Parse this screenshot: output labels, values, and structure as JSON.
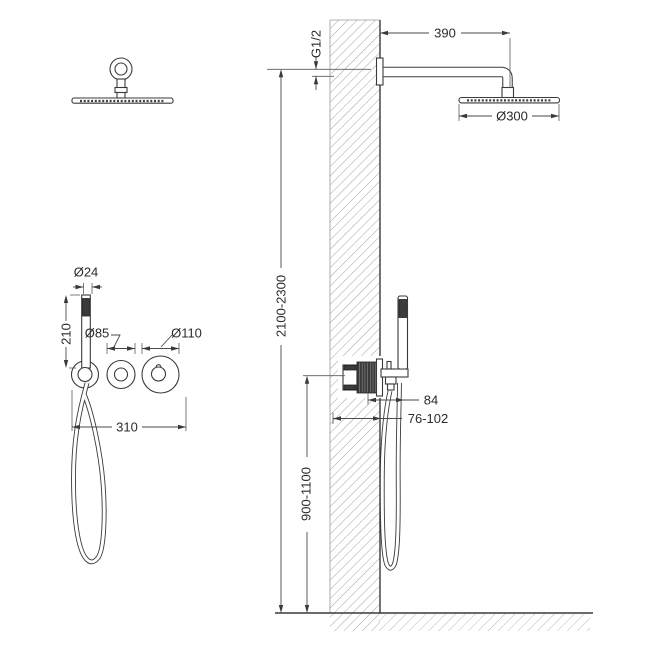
{
  "drawing": {
    "colors": {
      "line": "#3a3a3a",
      "hatch": "#9a9a9a",
      "background": "#ffffff",
      "dark_fill": "#3b3b3b"
    },
    "dimensions": {
      "arm_length": "390",
      "connection_thread": "G1/2",
      "rain_head_diameter": "Ø300",
      "installation_height": "2100-2300",
      "valve_height": "900-1100",
      "valve_protrusion": "84",
      "installation_depth": "76-102",
      "hand_shower_diameter": "Ø24",
      "hand_shower_length": "210",
      "trim_small_diameter": "Ø85",
      "trim_large_diameter": "Ø110",
      "trim_width": "310"
    }
  }
}
